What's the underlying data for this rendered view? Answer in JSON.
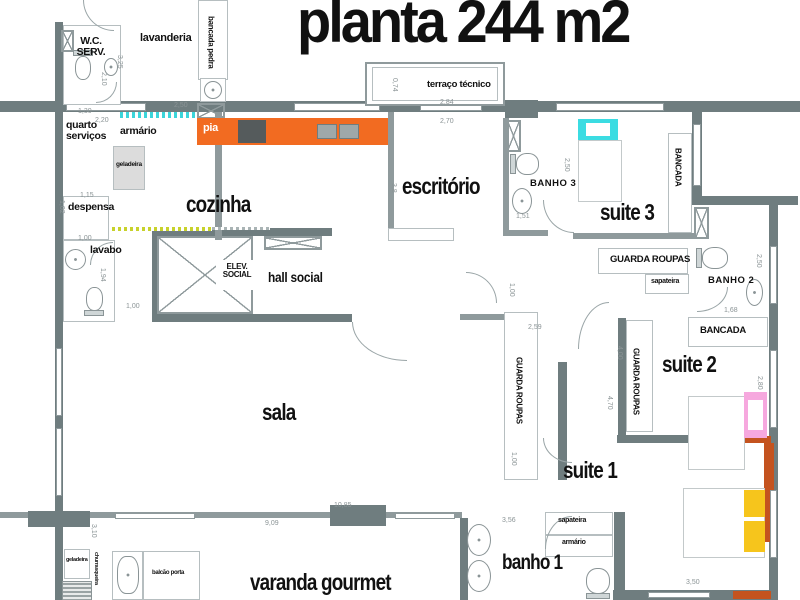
{
  "title": "planta 244 m2",
  "rooms": {
    "lavanderia": "lavanderia",
    "wc_serv": "W.C. SERV.",
    "quarto_servicos": "quarto serviços",
    "despensa": "despensa",
    "lavabo": "lavabo",
    "cozinha": "cozinha",
    "hall_social": "hall social",
    "elev_social": "ELEV. SOCIAL",
    "escritorio": "escritório",
    "terraco_tecnico": "terraço técnico",
    "banho3": "BANHO 3",
    "suite3": "suite 3",
    "banho2": "BANHO 2",
    "suite2": "suite 2",
    "suite1": "suite 1",
    "banho1": "banho 1",
    "sala": "sala",
    "varanda_gourmet": "varanda gourmet"
  },
  "fixtures": {
    "bancada_pedra": "bancada pedra",
    "pia": "pia",
    "armario": "armário",
    "geladeira": "geladeira",
    "guarda_roupas": "GUARDA ROUPAS",
    "sapateira": "sapateira",
    "bancada": "BANCADA",
    "balcao_porta": "balcão porta",
    "churrasqueira": "churrasqueira"
  },
  "dimensions": {
    "d130": "1,30",
    "d220": "2,20",
    "d250": "2,50",
    "d325": "3,25",
    "d210": "2,10",
    "d115": "1,15",
    "d102": "1,02",
    "d100": "1,00",
    "d194": "1,94",
    "d074": "0,74",
    "d284": "2,84",
    "d270": "2,70",
    "d38": "3,8",
    "d151": "1,51",
    "d168": "1,68",
    "d259": "2,59",
    "d400": "4,00",
    "d470": "4,70",
    "d280": "2,80",
    "d356": "3,56",
    "d350": "3,50",
    "d1085": "10,85",
    "d909": "9,09",
    "d310": "3,10"
  },
  "colors": {
    "wall": "#6f7d7f",
    "wall_light": "#8f9a9c",
    "counter_orange": "#f26b21",
    "accent_cyan": "#3bdce2",
    "accent_pink": "#f6a8de",
    "accent_yellow": "#f6c51c",
    "accent_rust": "#c4531f",
    "accent_lime": "#c8d22b"
  }
}
